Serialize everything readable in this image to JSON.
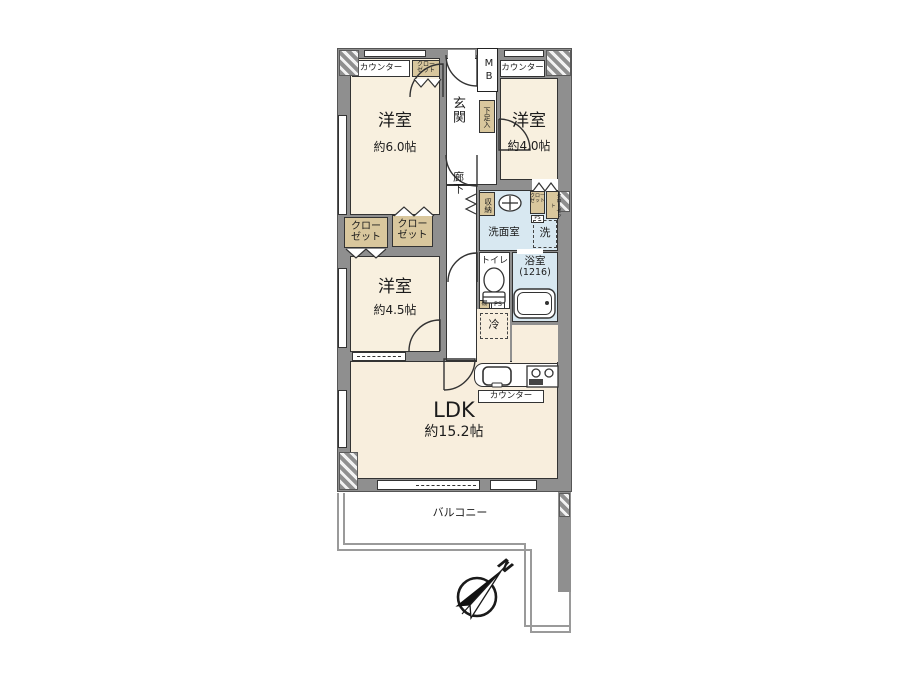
{
  "plan_type": "apartment-floor-plan",
  "colors": {
    "wall": "#8f8f8f",
    "room_floor": "#f8f0df",
    "ldk_floor": "#f8eedd",
    "wet_floor": "#d8e8f1",
    "closet_fill": "#d9c79d",
    "outline": "#333333",
    "balcony_line": "#9a9a9a"
  },
  "rooms": {
    "bedroom_6": {
      "name": "洋室",
      "size": "約6.0帖"
    },
    "bedroom_4": {
      "name": "洋室",
      "size": "約4.0帖"
    },
    "bedroom_4_5": {
      "name": "洋室",
      "size": "約4.5帖"
    },
    "ldk": {
      "name": "LDK",
      "size": "約15.2帖"
    },
    "entrance": {
      "name": "玄関"
    },
    "hallway": {
      "name": "廊下"
    },
    "washroom": {
      "name": "洗面室"
    },
    "bathroom": {
      "name": "浴室",
      "size": "(1216)"
    },
    "toilet": {
      "name": "トイレ"
    },
    "balcony": {
      "name": "バルコニー"
    }
  },
  "labels": {
    "counter": "カウンター",
    "closet_2line": [
      "クロー",
      "ゼット"
    ],
    "closet_vertical": "クローゼット",
    "shoe_cabinet": "下足入",
    "storage": "収納",
    "meter_box": "MB",
    "washer": "洗",
    "fridge": "冷",
    "shelf": "棚",
    "pipe_space": "PS",
    "north": "N"
  }
}
